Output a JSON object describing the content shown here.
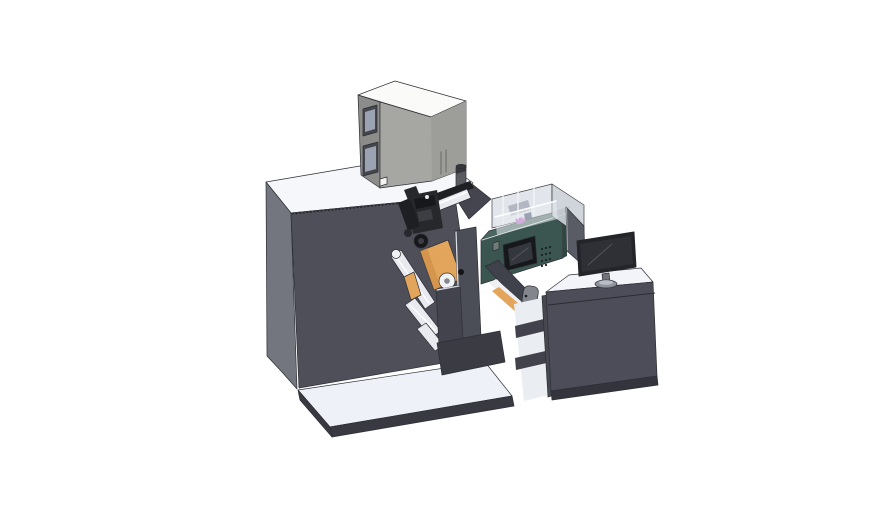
{
  "canvas": {
    "width": 888,
    "height": 522,
    "background": "#ffffff"
  },
  "scene": {
    "description_parts": [
      "base-platform",
      "main-machine-body",
      "electronics-enclosure",
      "signal-beacon",
      "print-mechanism",
      "guide-rollers",
      "label-rolls",
      "safety-cover",
      "hmi-control-panel",
      "web-chute",
      "operator-desk",
      "desk-monitor",
      "divider-panel"
    ]
  },
  "palette": {
    "background": "#ffffff",
    "white_top": "#f5f7fa",
    "platform_top": "#eef1f7",
    "platform_edge": "#383941",
    "machine_front": "#4e4f59",
    "machine_side": "#73757f",
    "machine_wedge": "#44454e",
    "box_top": "#fafbf9",
    "box_front": "#a6a6a2",
    "box_front_right": "#9d9d99",
    "box_side": "#8c8c8a",
    "box_window": "#9ba3b2",
    "box_window_frame": "#45474c",
    "box_square": "#f4f5f3",
    "beacon_body": "#5a5b60",
    "beacon_cap": "#35363b",
    "mech_dark": "#1e1f23",
    "mech_mid": "#26282c",
    "mech_detail_dark": "#17181b",
    "mech_detail_light": "#3c3e44",
    "roller_fill": "#e8eaef",
    "roller_cap": "#f1f2f5",
    "orange": "#e3a55c",
    "orange_dark": "#c8893f",
    "plate_front": "#42434c",
    "plate_tall": "#4b4d57",
    "base_block": "#3a3b43",
    "chute": "#3f414b",
    "web_white": "#eef0f4",
    "handle_grey": "#84868e",
    "teal": "#3b5650",
    "teal_top": "#4a6660",
    "teal_dark": "#2f4741",
    "teal_button": "#6f7b77",
    "screen_bezel": "#17181b",
    "screen_face": "#34373d",
    "cover_wall": "#dfe3e9",
    "cover_wall_side": "#ccd2d9",
    "cover_front": "#e8ecf0",
    "cover_mech": "#a9afba",
    "purple": "#b164c5",
    "magenta": "#cf5ecb",
    "navy_detail": "#3d4a66",
    "divider": "#595b65",
    "desk_top": "#f2f4f9",
    "desk_front": "#4c4d58",
    "desk_leg": "#474850",
    "desk_bay": "#eaedf2",
    "desk_band": "#41424b",
    "plinth": "#33343c",
    "monitor_bezel": "#242529",
    "monitor_screen": "#2e3035",
    "stand": "#8e929b",
    "stand_top": "#b8bcc3",
    "neck": "#70737b",
    "dot_grey": "#9aa0a8",
    "dot_dark": "#1f2023",
    "hole_dark": "#141518"
  }
}
